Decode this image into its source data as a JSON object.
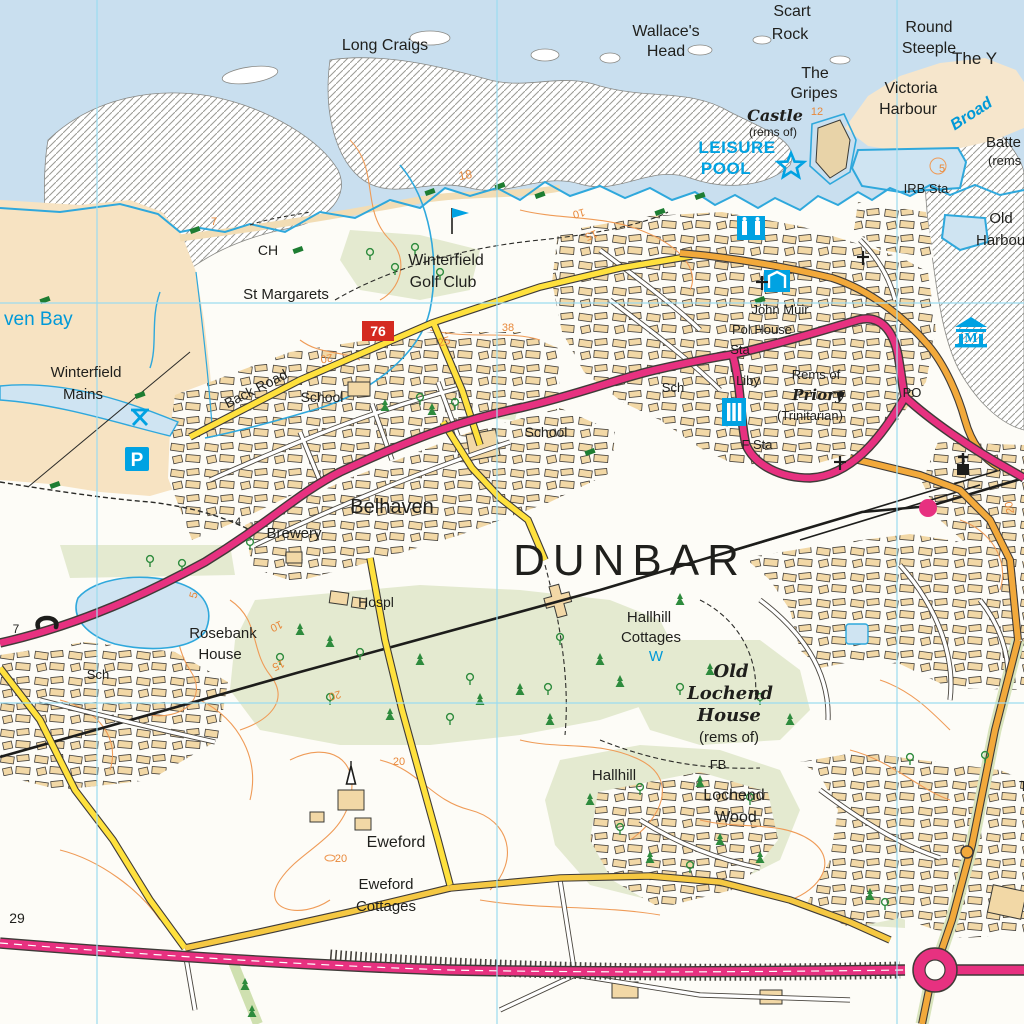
{
  "map": {
    "region_name": "Dunbar",
    "grid": {
      "vertical_x": [
        97,
        497,
        897
      ],
      "horizontal_y": [
        303,
        703
      ]
    },
    "colors": {
      "sea": "#c9dfef",
      "sand": "#f7e3c2",
      "building": "#f2d8a6",
      "field_green": "#e4ead0",
      "tree_green": "#2e8b3d",
      "contour_orange": "#ef9b57",
      "water_cyan": "#2fa8dc",
      "tourist_cyan": "#00a2e2",
      "a_road_pink": "#e73180",
      "b_road_orange": "#f2a93b",
      "minor_road_yellow": "#ffe13d",
      "grid_cyan": "#9bdcf0",
      "route_badge_red": "#d42a20"
    },
    "labels": [
      {
        "t": "Long Craigs",
        "x": 385,
        "y": 50,
        "fs": 16
      },
      {
        "t": "Wallace's",
        "x": 666,
        "y": 36,
        "fs": 16
      },
      {
        "t": "Head",
        "x": 666,
        "y": 56,
        "fs": 16
      },
      {
        "t": "Scart",
        "x": 792,
        "y": 16,
        "fs": 16
      },
      {
        "t": "Rock",
        "x": 790,
        "y": 39,
        "fs": 16
      },
      {
        "t": "Round",
        "x": 929,
        "y": 32,
        "fs": 16
      },
      {
        "t": "Steeple",
        "x": 929,
        "y": 53,
        "fs": 16
      },
      {
        "t": "The Y",
        "x": 952,
        "y": 64,
        "fs": 17,
        "a": "start"
      },
      {
        "t": "The",
        "x": 815,
        "y": 78,
        "fs": 16
      },
      {
        "t": "Gripes",
        "x": 814,
        "y": 98,
        "fs": 16
      },
      {
        "t": "Victoria",
        "x": 911,
        "y": 93,
        "fs": 16
      },
      {
        "t": "Harbour",
        "x": 908,
        "y": 114,
        "fs": 16
      },
      {
        "t": "Castle",
        "x": 775,
        "y": 121,
        "fs": 16,
        "cls": "bl"
      },
      {
        "t": "(rems of)",
        "x": 773,
        "y": 136,
        "fs": 12
      },
      {
        "t": "12",
        "x": 817,
        "y": 115,
        "fs": 11,
        "cls": "contour"
      },
      {
        "t": "LEISURE",
        "x": 737,
        "y": 153,
        "fs": 17,
        "cls": "tourist"
      },
      {
        "t": "POOL",
        "x": 726,
        "y": 174,
        "fs": 17,
        "cls": "tourist"
      },
      {
        "t": "Broad",
        "x": 974,
        "y": 118,
        "fs": 16,
        "cls": "water-i",
        "r": -33
      },
      {
        "t": "Batte",
        "x": 986,
        "y": 147,
        "fs": 15,
        "a": "start"
      },
      {
        "t": "(rems",
        "x": 988,
        "y": 165,
        "fs": 13,
        "a": "start"
      },
      {
        "t": "IRB Sta",
        "x": 926,
        "y": 193,
        "fs": 13
      },
      {
        "t": "Old",
        "x": 1001,
        "y": 223,
        "fs": 15
      },
      {
        "t": "Harbou",
        "x": 976,
        "y": 245,
        "fs": 15,
        "a": "start"
      },
      {
        "t": "5",
        "x": 942,
        "y": 172,
        "fs": 11,
        "cls": "contour"
      },
      {
        "t": "CH",
        "x": 268,
        "y": 255,
        "fs": 14
      },
      {
        "t": "St Margarets",
        "x": 286,
        "y": 299,
        "fs": 15
      },
      {
        "t": "Winterfield",
        "x": 446,
        "y": 265,
        "fs": 16
      },
      {
        "t": "Golf Club",
        "x": 443,
        "y": 287,
        "fs": 16
      },
      {
        "t": "7",
        "x": 214,
        "y": 225,
        "fs": 11,
        "cls": "contour"
      },
      {
        "t": "18",
        "x": 466,
        "y": 179,
        "fs": 12,
        "cls": "contour",
        "r": -10
      },
      {
        "t": "10",
        "x": 578,
        "y": 210,
        "fs": 11,
        "cls": "contour",
        "r": 165
      },
      {
        "t": "15",
        "x": 590,
        "y": 232,
        "fs": 11,
        "cls": "contour",
        "r": 160
      },
      {
        "t": "Winterfield",
        "x": 86,
        "y": 377,
        "fs": 15
      },
      {
        "t": "Mains",
        "x": 83,
        "y": 399,
        "fs": 15
      },
      {
        "t": "ven Bay",
        "x": 4,
        "y": 325,
        "fs": 19,
        "a": "start",
        "cls": "water"
      },
      {
        "t": "Back Road",
        "x": 258,
        "y": 393,
        "fs": 14,
        "r": -27
      },
      {
        "t": "School",
        "x": 322,
        "y": 402,
        "fs": 14
      },
      {
        "t": "School",
        "x": 546,
        "y": 437,
        "fs": 14
      },
      {
        "t": "20",
        "x": 326,
        "y": 355,
        "fs": 11,
        "cls": "contour",
        "r": 170
      },
      {
        "t": "25",
        "x": 445,
        "y": 345,
        "fs": 11,
        "cls": "contour",
        "r": -15
      },
      {
        "t": "38",
        "x": 508,
        "y": 331,
        "fs": 11,
        "cls": "contour"
      },
      {
        "t": "John Muir",
        "x": 780,
        "y": 314,
        "fs": 13
      },
      {
        "t": "Pol House",
        "x": 762,
        "y": 334,
        "fs": 13
      },
      {
        "t": "Sta",
        "x": 740,
        "y": 354,
        "fs": 13
      },
      {
        "t": "Liby",
        "x": 748,
        "y": 385,
        "fs": 13
      },
      {
        "t": "Rems of",
        "x": 816,
        "y": 379,
        "fs": 13
      },
      {
        "t": "Priory",
        "x": 818,
        "y": 400,
        "fs": 15,
        "cls": "bl"
      },
      {
        "t": "(Trinitarian)",
        "x": 810,
        "y": 420,
        "fs": 13
      },
      {
        "t": "Sch",
        "x": 673,
        "y": 392,
        "fs": 13
      },
      {
        "t": "F Sta",
        "x": 757,
        "y": 449,
        "fs": 13
      },
      {
        "t": "PO",
        "x": 912,
        "y": 397,
        "fs": 13
      },
      {
        "t": "Belhaven",
        "x": 392,
        "y": 513,
        "fs": 20
      },
      {
        "t": "Brewery",
        "x": 294,
        "y": 538,
        "fs": 15
      },
      {
        "t": "4",
        "x": 238,
        "y": 525,
        "fs": 11,
        "cls": "spot"
      },
      {
        "t": "DUNBAR",
        "x": 630,
        "y": 575,
        "fs": 44,
        "cls": "town"
      },
      {
        "t": "Hospl",
        "x": 376,
        "y": 607,
        "fs": 14
      },
      {
        "t": "Rosebank",
        "x": 223,
        "y": 638,
        "fs": 15
      },
      {
        "t": "House",
        "x": 220,
        "y": 659,
        "fs": 15
      },
      {
        "t": "5",
        "x": 197,
        "y": 596,
        "fs": 11,
        "cls": "contour",
        "r": -75
      },
      {
        "t": "10",
        "x": 275,
        "y": 623,
        "fs": 11,
        "cls": "contour",
        "r": 155
      },
      {
        "t": "15",
        "x": 277,
        "y": 662,
        "fs": 11,
        "cls": "contour",
        "r": 155
      },
      {
        "t": "20",
        "x": 334,
        "y": 692,
        "fs": 11,
        "cls": "contour",
        "r": 165
      },
      {
        "t": "Sch",
        "x": 98,
        "y": 679,
        "fs": 13
      },
      {
        "t": "7",
        "x": 16,
        "y": 633,
        "fs": 12,
        "cls": "spot"
      },
      {
        "t": "Hallhill",
        "x": 649,
        "y": 622,
        "fs": 15
      },
      {
        "t": "Cottages",
        "x": 651,
        "y": 642,
        "fs": 15
      },
      {
        "t": "W",
        "x": 656,
        "y": 661,
        "fs": 15,
        "cls": "water"
      },
      {
        "t": "Old",
        "x": 731,
        "y": 677,
        "fs": 18,
        "cls": "bl"
      },
      {
        "t": "Lochend",
        "x": 730,
        "y": 699,
        "fs": 18,
        "cls": "bl"
      },
      {
        "t": "House",
        "x": 729,
        "y": 721,
        "fs": 18,
        "cls": "bl"
      },
      {
        "t": "(rems of)",
        "x": 729,
        "y": 742,
        "fs": 15
      },
      {
        "t": "FB",
        "x": 718,
        "y": 769,
        "fs": 13
      },
      {
        "t": "Lochend",
        "x": 734,
        "y": 800,
        "fs": 16
      },
      {
        "t": "Wood",
        "x": 736,
        "y": 822,
        "fs": 16
      },
      {
        "t": "Hallhill",
        "x": 614,
        "y": 780,
        "fs": 15
      },
      {
        "t": "Eweford",
        "x": 396,
        "y": 847,
        "fs": 16
      },
      {
        "t": "Eweford",
        "x": 386,
        "y": 889,
        "fs": 15
      },
      {
        "t": "Cottages",
        "x": 386,
        "y": 911,
        "fs": 15
      },
      {
        "t": "20",
        "x": 399,
        "y": 765,
        "fs": 11,
        "cls": "contour"
      },
      {
        "t": "20",
        "x": 341,
        "y": 862,
        "fs": 11,
        "cls": "contour"
      },
      {
        "t": "20",
        "x": 1013,
        "y": 507,
        "fs": 11,
        "cls": "contour",
        "r": -100
      },
      {
        "t": "29",
        "x": 17,
        "y": 923,
        "fs": 14,
        "cls": "spot"
      },
      {
        "t": "T",
        "x": 1019,
        "y": 791,
        "fs": 15,
        "a": "start"
      }
    ],
    "icons": [
      {
        "n": "golf-flag-icon",
        "x": 452,
        "y": 218
      },
      {
        "n": "leisure-pool-star-icon",
        "x": 791,
        "y": 166
      },
      {
        "n": "parking-icon",
        "x": 137,
        "y": 459
      },
      {
        "n": "picnic-site-icon",
        "x": 140,
        "y": 416
      },
      {
        "n": "leisure-centre-icon",
        "x": 751,
        "y": 228
      },
      {
        "n": "sports-centre-icon",
        "x": 777,
        "y": 281
      },
      {
        "n": "library-icon",
        "x": 734,
        "y": 412
      },
      {
        "n": "museum-icon",
        "x": 971,
        "y": 333
      },
      {
        "n": "telephone-icon",
        "x": 47,
        "y": 620
      },
      {
        "n": "church-with-tower-icon",
        "x": 963,
        "y": 466
      },
      {
        "n": "church-cross-icon",
        "x": 762,
        "y": 283
      },
      {
        "n": "church-cross-icon",
        "x": 863,
        "y": 258
      },
      {
        "n": "church-cross-icon",
        "x": 840,
        "y": 463
      },
      {
        "n": "spire-icon",
        "x": 351,
        "y": 781
      },
      {
        "n": "railway-station-icon",
        "x": 928,
        "y": 508
      },
      {
        "n": "spot-height-dot",
        "x": 841,
        "y": 394
      },
      {
        "n": "cycle-route-badge",
        "x": 378,
        "y": 331,
        "t": "76"
      }
    ],
    "vegetation": [
      {
        "kind": "conifer",
        "pts": [
          [
            385,
            406
          ],
          [
            432,
            410
          ],
          [
            300,
            630
          ],
          [
            330,
            642
          ],
          [
            420,
            660
          ],
          [
            520,
            690
          ],
          [
            600,
            660
          ],
          [
            390,
            715
          ],
          [
            550,
            720
          ],
          [
            620,
            682
          ],
          [
            590,
            800
          ],
          [
            650,
            858
          ],
          [
            720,
            840
          ],
          [
            700,
            782
          ],
          [
            760,
            858
          ],
          [
            710,
            670
          ],
          [
            790,
            720
          ],
          [
            870,
            895
          ],
          [
            245,
            985
          ],
          [
            252,
            1012
          ],
          [
            680,
            600
          ],
          [
            480,
            700
          ]
        ]
      },
      {
        "kind": "deciduous",
        "pts": [
          [
            370,
            255
          ],
          [
            395,
            270
          ],
          [
            440,
            275
          ],
          [
            415,
            250
          ],
          [
            420,
            400
          ],
          [
            455,
            405
          ],
          [
            360,
            655
          ],
          [
            470,
            680
          ],
          [
            560,
            640
          ],
          [
            330,
            700
          ],
          [
            450,
            720
          ],
          [
            280,
            660
          ],
          [
            620,
            830
          ],
          [
            690,
            868
          ],
          [
            750,
            800
          ],
          [
            640,
            790
          ],
          [
            680,
            690
          ],
          [
            760,
            700
          ],
          [
            885,
            905
          ],
          [
            150,
            562
          ],
          [
            182,
            566
          ],
          [
            250,
            545
          ],
          [
            910,
            760
          ],
          [
            985,
            758
          ],
          [
            548,
            690
          ]
        ]
      },
      {
        "kind": "scrub",
        "pts": [
          [
            45,
            300
          ],
          [
            140,
            395
          ],
          [
            55,
            485
          ],
          [
            195,
            230
          ],
          [
            430,
            192
          ],
          [
            500,
            186
          ],
          [
            660,
            212
          ],
          [
            700,
            196
          ],
          [
            540,
            195
          ],
          [
            298,
            250
          ],
          [
            760,
            300
          ],
          [
            590,
            452
          ]
        ]
      }
    ]
  }
}
